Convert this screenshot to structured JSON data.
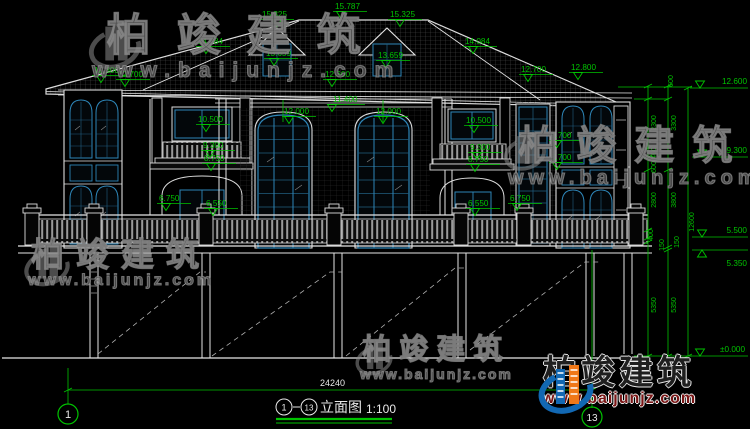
{
  "colors": {
    "background": "#000000",
    "line_white": "#e6e6e6",
    "dim_green": "#00c300",
    "window_blue": "#2e86b8",
    "logo_blue": "#1268b3",
    "logo_orange": "#f07818",
    "url_red": "#7a1616",
    "watermark_gray": "#8a8a8a"
  },
  "watermark": {
    "brand": "柏竣建筑",
    "url": "www.baijunjz.com"
  },
  "drawing": {
    "elev_marks": [
      "15.787",
      "15.325",
      "15.325",
      "14.084",
      "14.084",
      "13.659",
      "13.659",
      "12.800",
      "12.700",
      "12.700",
      "12.800",
      "12.600",
      "11.400",
      "12.000",
      "12.000",
      "10.500",
      "10.500",
      "9.300",
      "8.750",
      "9.300",
      "8.750",
      "9.700",
      "8.700",
      "6.750",
      "6.550",
      "6.550",
      "6.750"
    ],
    "right_marks": [
      "12.600",
      "9.300",
      "5.500",
      "5.350",
      "±0.000"
    ],
    "vdims": [
      "600",
      "2300",
      "400",
      "600",
      "2800",
      "400",
      "150",
      "5350",
      "3300",
      "3800",
      "150",
      "5350",
      "12600"
    ],
    "bottom_dim": "24240",
    "axis_left": "1",
    "axis_right": "13"
  },
  "titlebar": {
    "from": "1",
    "to": "13",
    "label": "立面图",
    "scale": "1:100"
  }
}
